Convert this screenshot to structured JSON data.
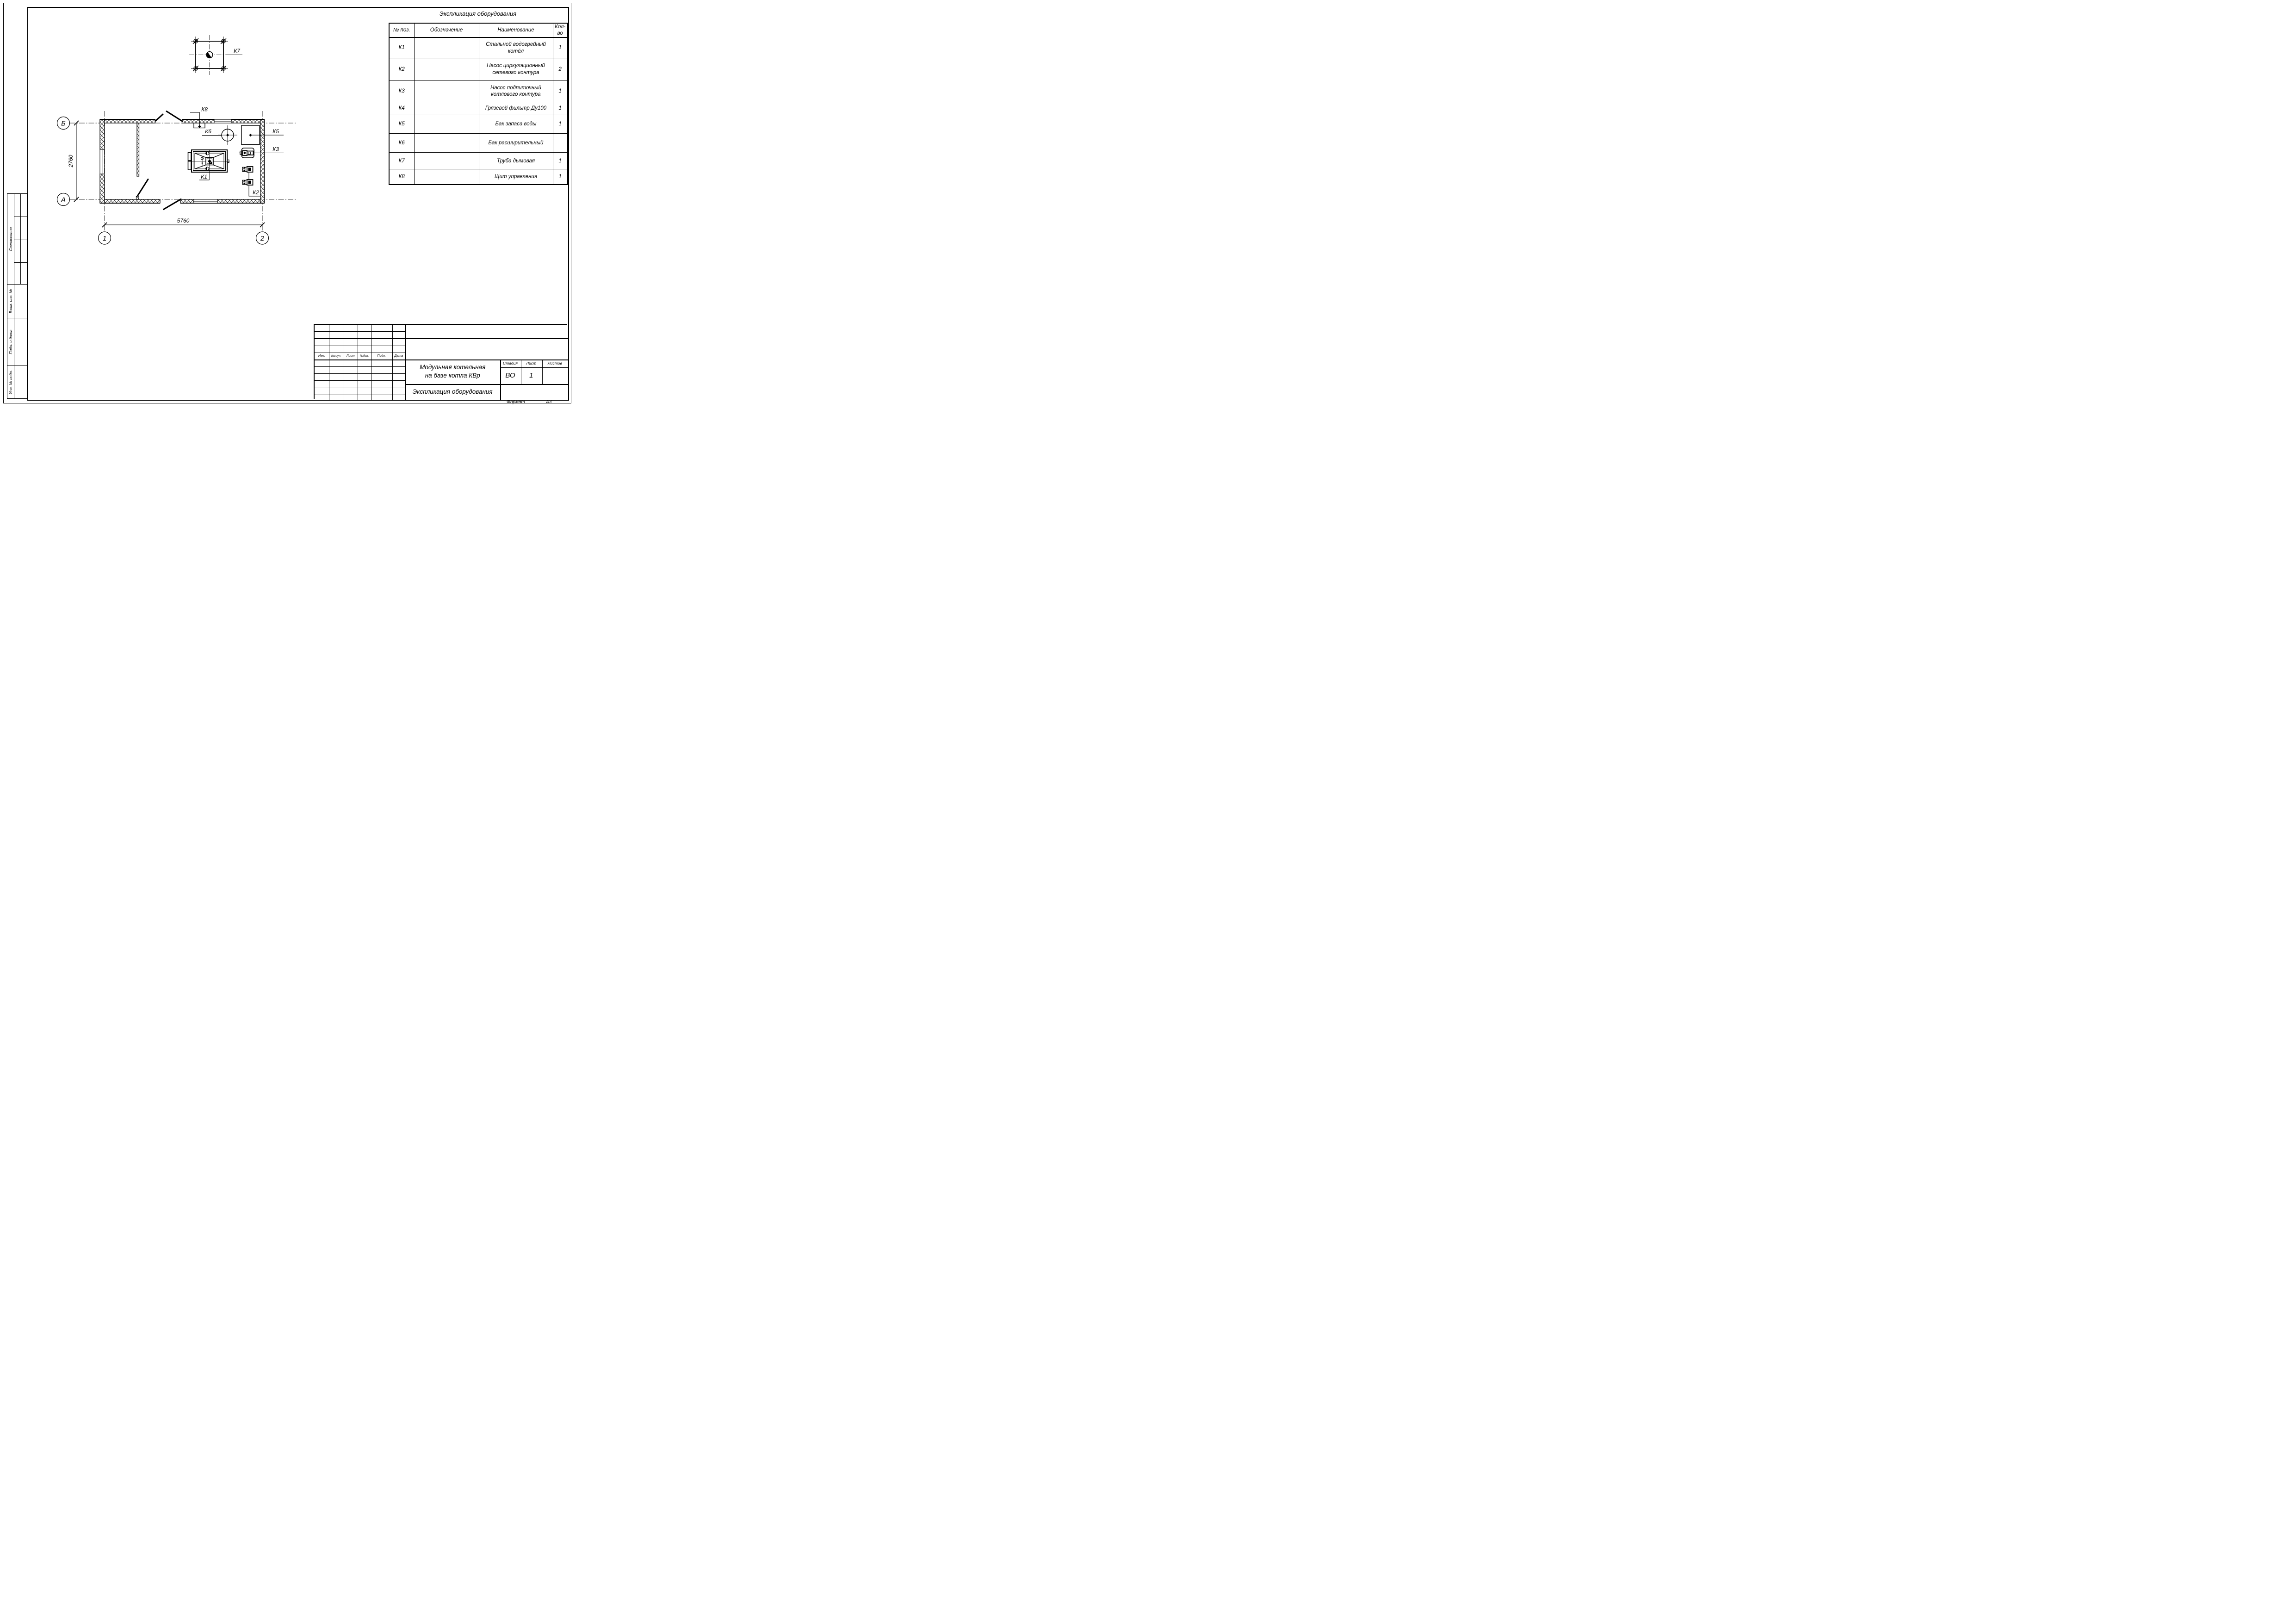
{
  "sheet": {
    "format_label": "Формат",
    "format_value": "А3"
  },
  "equipment_table": {
    "title": "Экспликация оборудования",
    "headers": {
      "pos": "№ поз.",
      "designation": "Обозначение",
      "name": "Наименование",
      "qty": "Кол-во"
    },
    "rows": [
      {
        "pos": "К1",
        "designation": "",
        "name": "Стальной водогрейный котёл",
        "qty": "1"
      },
      {
        "pos": "К2",
        "designation": "",
        "name": "Насос циркуляционный сетевого контура",
        "qty": "2"
      },
      {
        "pos": "К3",
        "designation": "",
        "name": "Насос подпиточный котлового контура",
        "qty": "1"
      },
      {
        "pos": "К4",
        "designation": "",
        "name": "Грязевой фильтр Ду100",
        "qty": "1"
      },
      {
        "pos": "К5",
        "designation": "",
        "name": "Бак запаса воды",
        "qty": "1"
      },
      {
        "pos": "К6",
        "designation": "",
        "name": "Бак расширительный",
        "qty": ""
      },
      {
        "pos": "К7",
        "designation": "",
        "name": "Труба дымовая",
        "qty": "1"
      },
      {
        "pos": "К8",
        "designation": "",
        "name": "Щит управления",
        "qty": "1"
      }
    ]
  },
  "plan": {
    "axes": {
      "row_top": "Б",
      "row_bottom": "А",
      "col_left": "1",
      "col_right": "2"
    },
    "dimensions": {
      "width": "5760",
      "height": "2760"
    },
    "labels": {
      "k1": "К1",
      "k2": "К2",
      "k3": "К3",
      "k5": "К5",
      "k6": "К6",
      "k7": "К7",
      "k8": "К8"
    }
  },
  "title_block": {
    "project_line1": "Модульная котельная",
    "project_line2": "на базе котла КВр",
    "doc_title": "Экспликация оборудования",
    "stage_label": "Стадия",
    "sheet_label": "Лист",
    "sheets_label": "Листов",
    "stage_value": "ВО",
    "sheet_value": "1",
    "sheets_value": "",
    "rev_headers": {
      "izm": "Изм.",
      "koluch": "Кол.уч.",
      "list": "Лист",
      "ndok": "№док.",
      "podp": "Подп.",
      "data": "Дата"
    }
  },
  "side_stamps": {
    "approved": "Согласовано",
    "vzam": "Взам. инв. №",
    "podp_data": "Подп. и дата",
    "inv_podl": "Инв. № подл."
  }
}
